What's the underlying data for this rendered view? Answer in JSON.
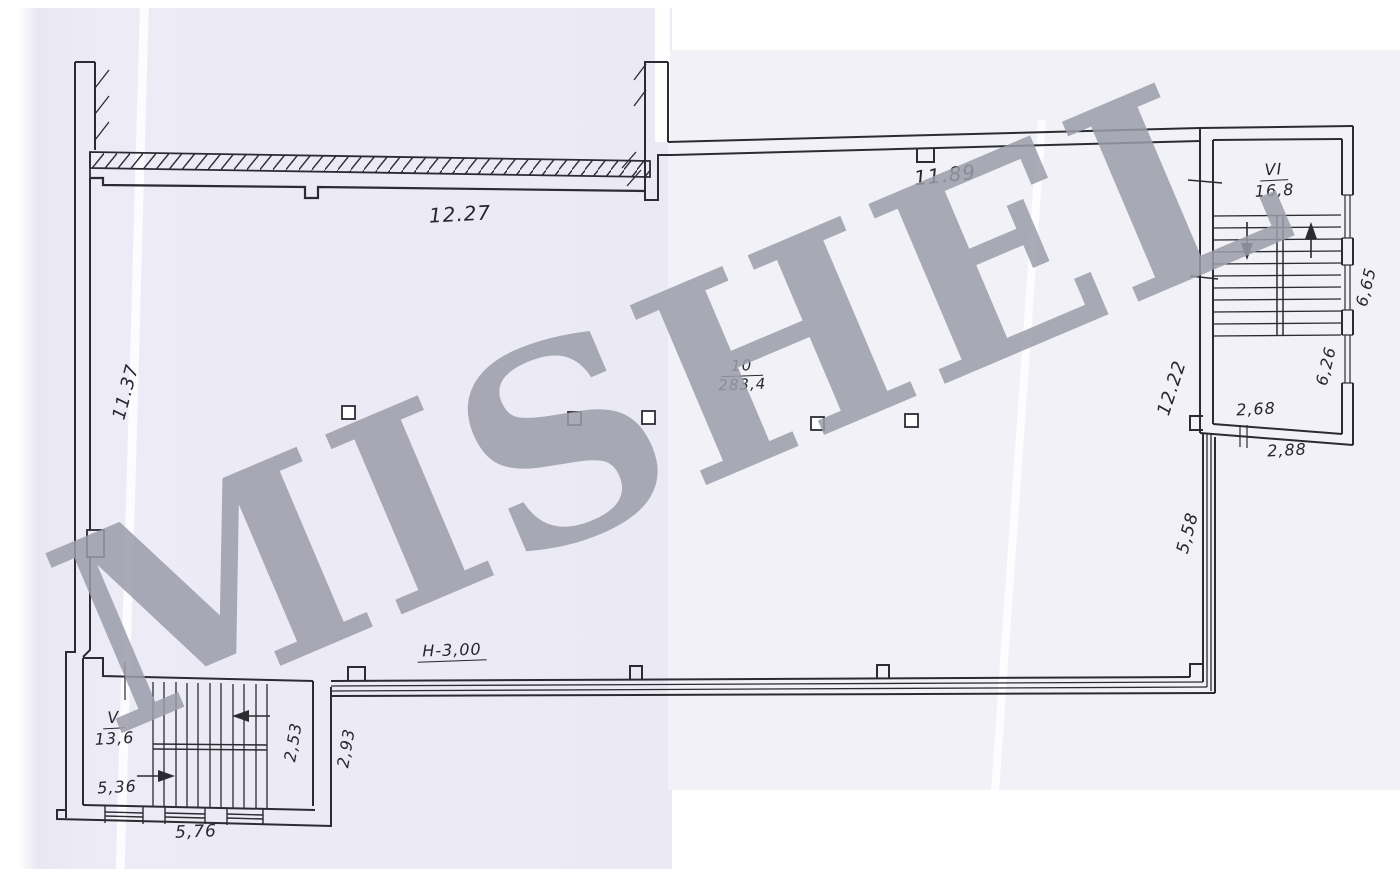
{
  "watermark": {
    "text": "MISHEL",
    "color": "#9b9daa"
  },
  "palette": {
    "paper_left": "#ebe9f3",
    "paper_right": "#f2f1f8",
    "line": "#2b2b31"
  },
  "plan": {
    "room": {
      "number": "10",
      "area": "283,4"
    },
    "height_mark": "H-3,00",
    "dims": {
      "top_left_wall": "12.27",
      "top_right_wall": "11.89",
      "left_wall": "11.37",
      "right_wall_upper": "12.22",
      "right_wall_lower": "5,58"
    },
    "stair_v": {
      "name": "V",
      "area": "13,6",
      "inner_width": "5,36",
      "outer_width": "5,76",
      "inner_depth": "2,53",
      "outer_depth": "2,93"
    },
    "stair_vi": {
      "name": "VI",
      "area": "16,8",
      "inner_width": "2,68",
      "outer_width": "2,88",
      "inner_height": "6,26",
      "outer_height": "6,65"
    }
  }
}
